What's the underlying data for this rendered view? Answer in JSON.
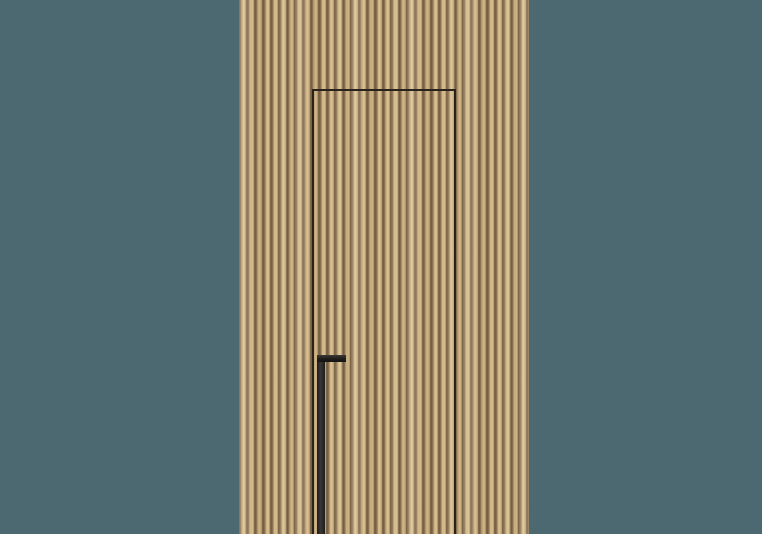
{
  "scene": {
    "description": "Photorealistic render of a concealed flush interior door set into a wall of vertical light-oak wood slats, with a slim black L-shaped handle bar near the lower left of the door leaf, centered on a muted teal background",
    "label": "Concealed slatted wood door"
  },
  "colors": {
    "backdrop": "#4c6871",
    "wood-face": "#cfb487",
    "wood-face-light": "#dac292",
    "wood-groove": "#8b7251",
    "wood-groove-dark": "#6e5a3f",
    "door-gap": "#2a231b",
    "handle": "#1e1d1b",
    "handle-highlight": "#3a3835"
  }
}
